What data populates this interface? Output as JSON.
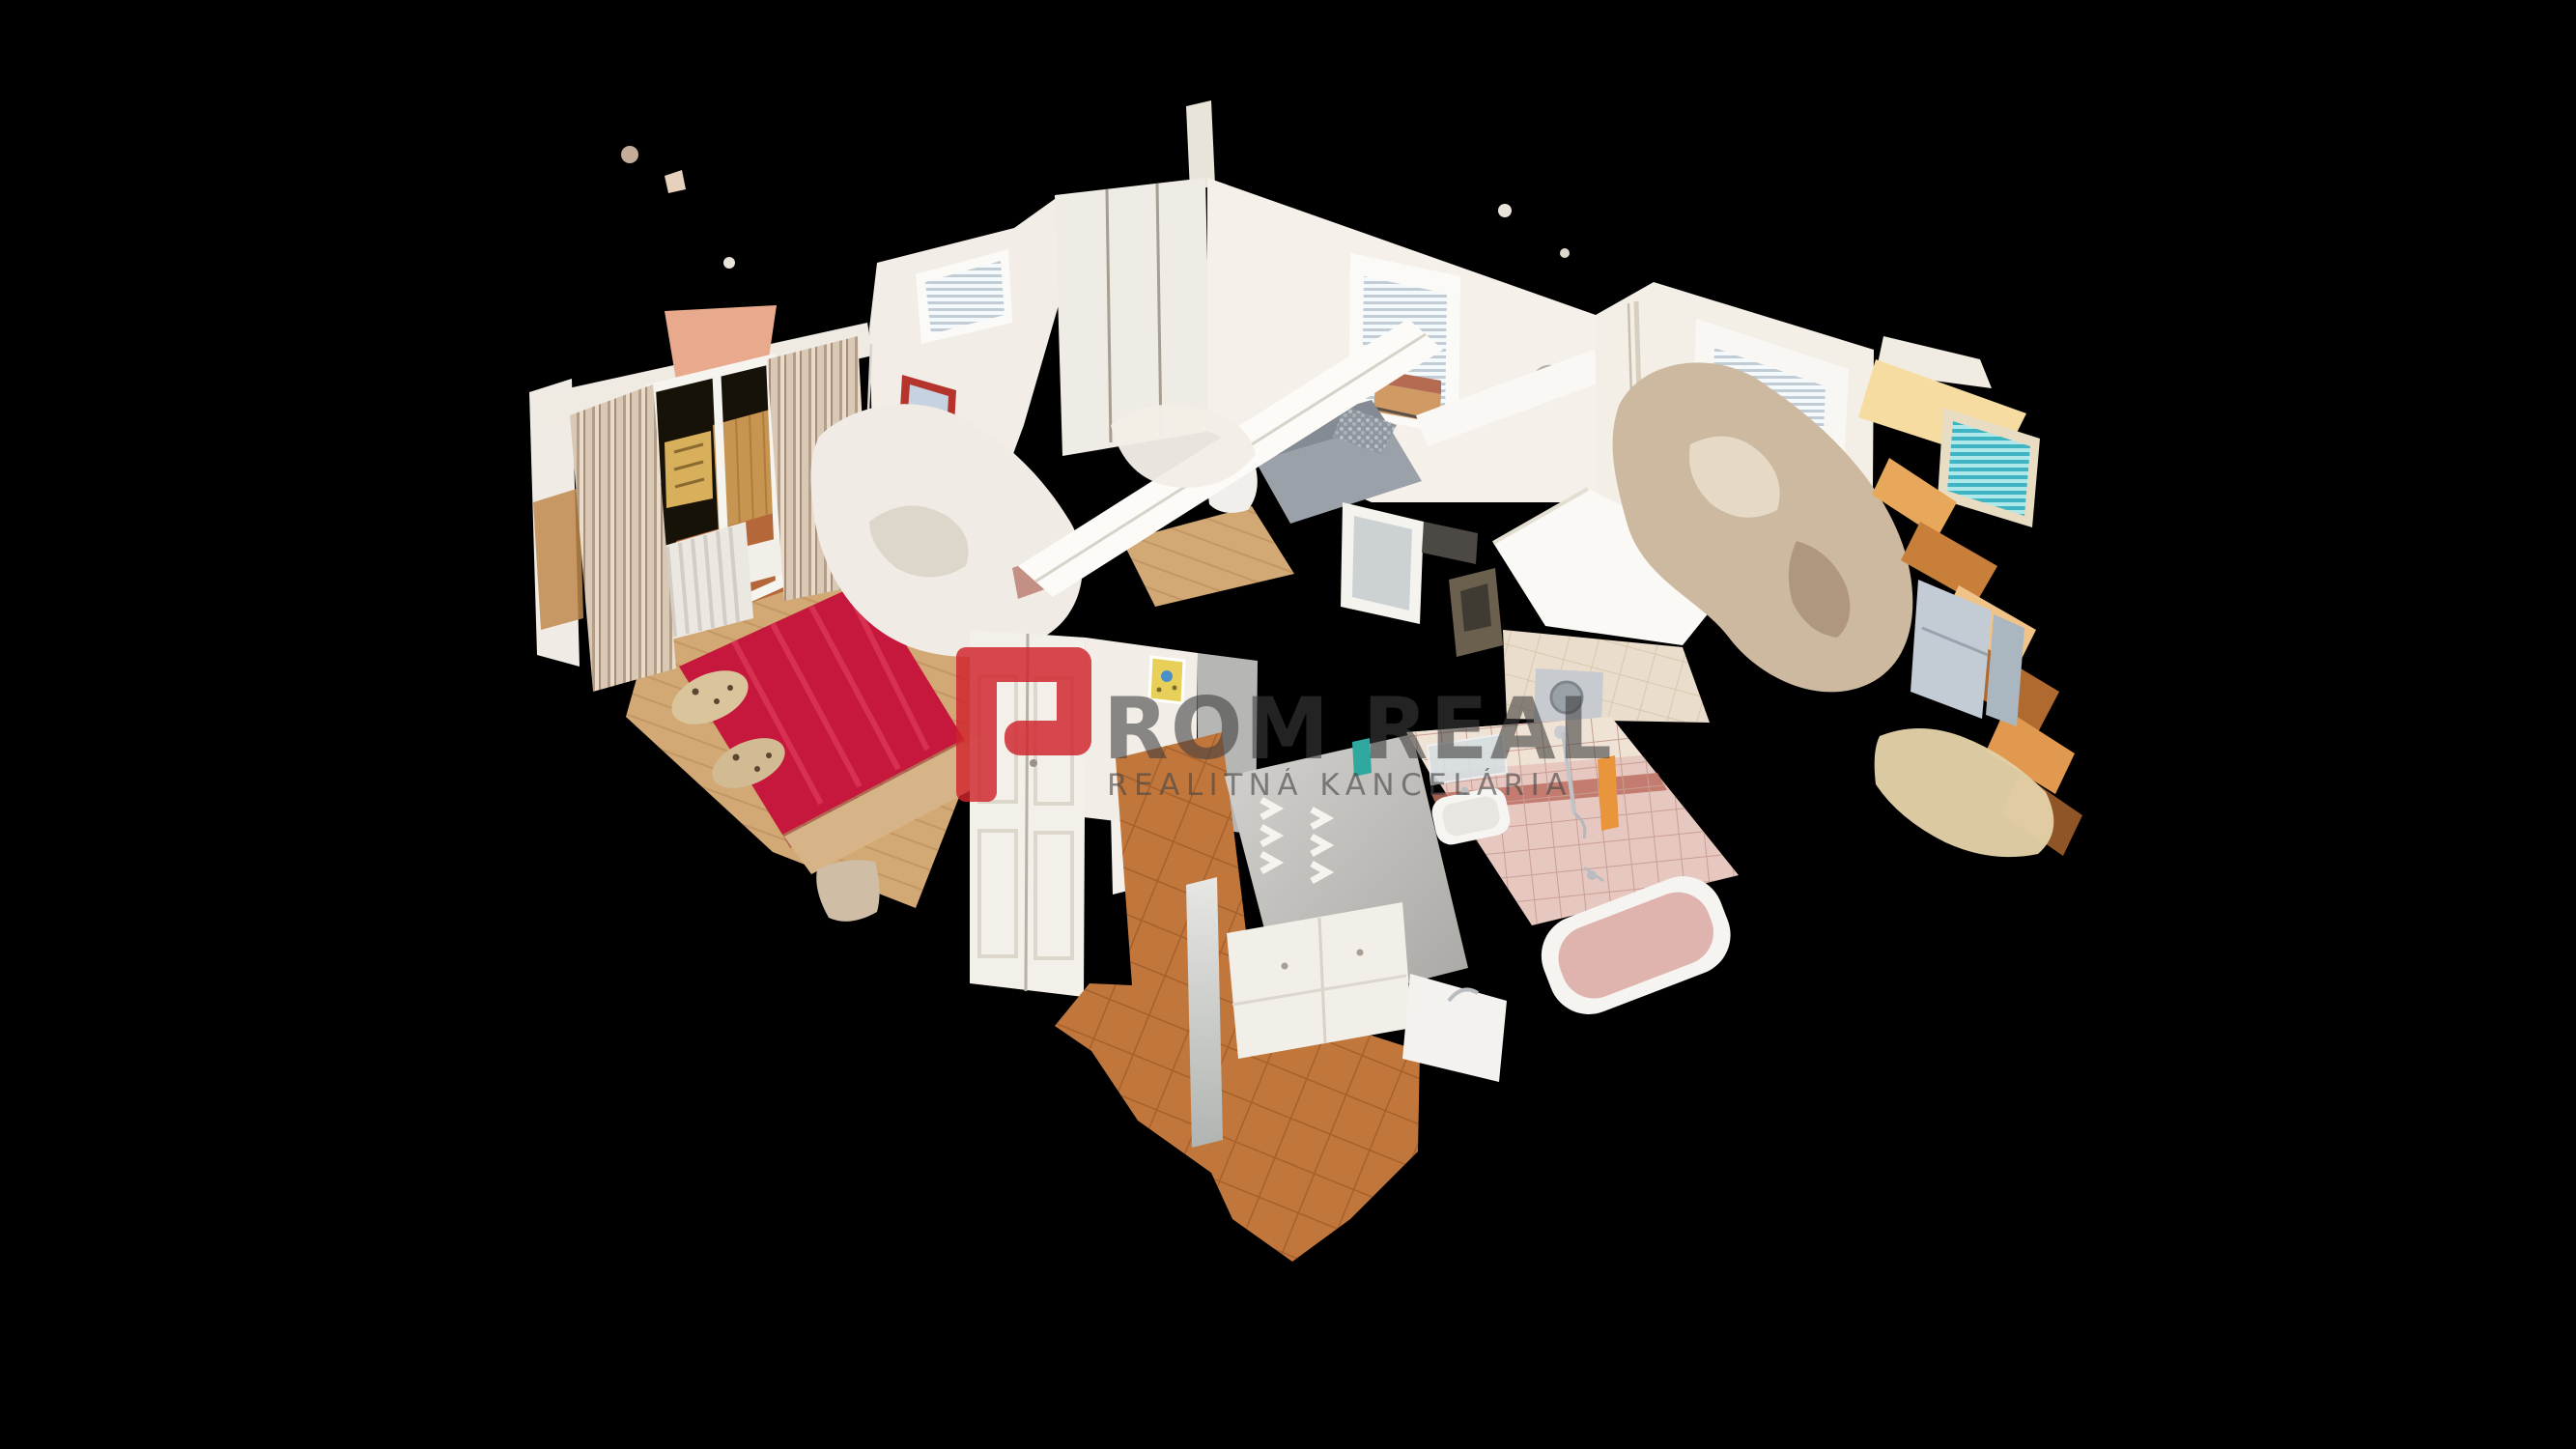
{
  "scene": {
    "type": "3d-dollhouse-apartment-scan",
    "background_color": "#000000",
    "rooms": [
      {
        "name": "bedroom",
        "items": [
          "red-double-bed",
          "balcony-door",
          "curtains",
          "radiator",
          "picture-frame",
          "pendant-lamp",
          "wood-floor",
          "window-blinds"
        ]
      },
      {
        "name": "living-room",
        "items": [
          "sliding-wardrobe",
          "window-blinds",
          "wall-clock",
          "gray-sofa",
          "wood-floor",
          "glass-door"
        ]
      },
      {
        "name": "kitchen",
        "items": [
          "window-blinds",
          "yellow-radiator",
          "dining-chairs",
          "wall-pipe",
          "teal-blinds-window",
          "fridge"
        ]
      },
      {
        "name": "bathroom",
        "items": [
          "bathtub",
          "washbasin",
          "shower",
          "pink-wall-tiles",
          "washing-machine",
          "towel-ring"
        ]
      },
      {
        "name": "hallway",
        "items": [
          "terracotta-tile-floor",
          "coat-hooks",
          "shoe-cabinet",
          "mirror",
          "double-door-wardrobe",
          "yellow-picture"
        ]
      }
    ]
  },
  "watermark": {
    "logo_letter": "P",
    "brand_text": "ROM REAL",
    "tagline": "REALITNÁ KANCELÁRIA",
    "logo_color": "#d0232b",
    "text_color": "#3d3d3d",
    "tagline_color": "#474747"
  },
  "palette": {
    "background": "#000000",
    "wall_white": "#f3efe8",
    "wood_floor": "#d2a874",
    "bed_red": "#c6173c",
    "tile_terracotta": "#c1763b",
    "tile_pink": "#e6c8c0",
    "curtain_beige": "#cbb49e",
    "radiator_yellow": "#f0d488",
    "warm_light": "#f7dca2",
    "sofa_gray": "#9aa1a9",
    "mesh_tan": "#cdb99f",
    "gray_wall": "#c2c0bc"
  }
}
